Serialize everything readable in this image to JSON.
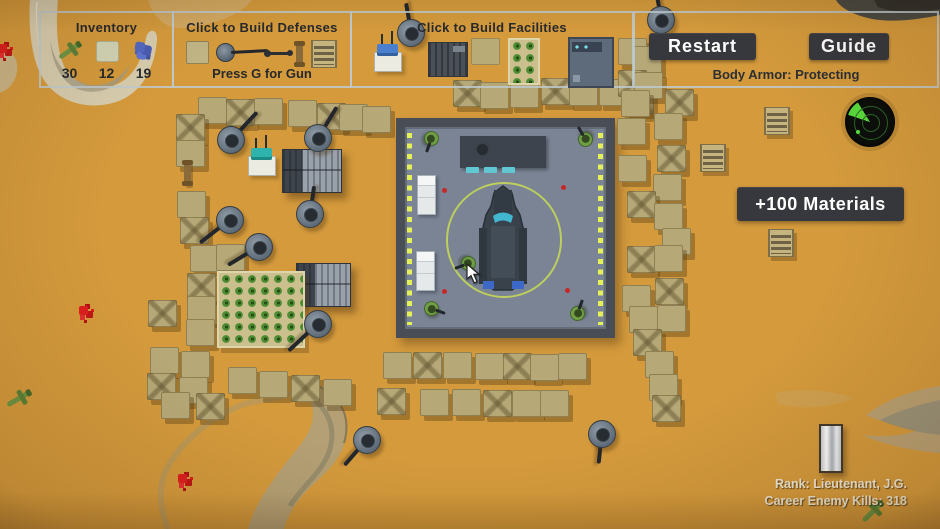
{
  "hud": {
    "inventory": {
      "title": "Inventory",
      "items": [
        {
          "name": "plane-parts",
          "count": "30"
        },
        {
          "name": "sandbags",
          "count": "12"
        },
        {
          "name": "scrap",
          "count": "19"
        }
      ]
    },
    "defenses": {
      "title": "Click to Build Defenses",
      "hint": "Press G for Gun"
    },
    "facilities": {
      "title": "Click to Build Facilities"
    },
    "restart_label": "Restart",
    "guide_label": "Guide",
    "body_armor": "Body Armor: Protecting",
    "materials_label": "+100 Materials",
    "rank_line": "Rank: Lieutenant, J.G.",
    "kills_line": "Career Enemy Kills: 318"
  },
  "colors": {
    "sand": "#d49a3c",
    "ui_border": "#becacf",
    "button_bg": "#36383d",
    "base_fill": "#7a8495",
    "base_border": "#484d56",
    "dash_yellow": "#e6f157",
    "sandbag": "#b6a877",
    "crop_green": "#4e8c33",
    "alert_red": "#c62828",
    "radar_green": "#59e23b",
    "rank_text": "#efe7d2"
  },
  "world": {
    "sandbags": [
      [
        198,
        97
      ],
      [
        226,
        99
      ],
      [
        254,
        98
      ],
      [
        288,
        100
      ],
      [
        317,
        103
      ],
      [
        339,
        104
      ],
      [
        362,
        106
      ],
      [
        176,
        114
      ],
      [
        176,
        140
      ],
      [
        177,
        191
      ],
      [
        180,
        217
      ],
      [
        190,
        245
      ],
      [
        216,
        244
      ],
      [
        187,
        273
      ],
      [
        187,
        296
      ],
      [
        186,
        319
      ],
      [
        148,
        300
      ],
      [
        150,
        347
      ],
      [
        181,
        351
      ],
      [
        147,
        373
      ],
      [
        179,
        377
      ],
      [
        161,
        392
      ],
      [
        196,
        393
      ],
      [
        228,
        367
      ],
      [
        259,
        371
      ],
      [
        291,
        375
      ],
      [
        323,
        379
      ],
      [
        383,
        352
      ],
      [
        413,
        352
      ],
      [
        443,
        352
      ],
      [
        475,
        353
      ],
      [
        503,
        353
      ],
      [
        530,
        354
      ],
      [
        558,
        353
      ],
      [
        377,
        388
      ],
      [
        420,
        389
      ],
      [
        452,
        389
      ],
      [
        483,
        390
      ],
      [
        512,
        390
      ],
      [
        540,
        390
      ],
      [
        453,
        80
      ],
      [
        480,
        82
      ],
      [
        510,
        81
      ],
      [
        541,
        78
      ],
      [
        569,
        79
      ],
      [
        599,
        79
      ],
      [
        625,
        87
      ],
      [
        618,
        38
      ],
      [
        633,
        46
      ],
      [
        618,
        70
      ],
      [
        634,
        72
      ],
      [
        621,
        90
      ],
      [
        665,
        89
      ],
      [
        654,
        113
      ],
      [
        617,
        118
      ],
      [
        657,
        145
      ],
      [
        618,
        155
      ],
      [
        653,
        174
      ],
      [
        627,
        191
      ],
      [
        654,
        203
      ],
      [
        662,
        228
      ],
      [
        627,
        246
      ],
      [
        654,
        245
      ],
      [
        622,
        285
      ],
      [
        655,
        278
      ],
      [
        629,
        306
      ],
      [
        657,
        305
      ],
      [
        633,
        329
      ],
      [
        645,
        351
      ],
      [
        649,
        374
      ],
      [
        652,
        395
      ]
    ],
    "posts": [
      [
        184,
        161
      ]
    ],
    "turrets": [
      [
        231,
        140,
        -47,
        38
      ],
      [
        318,
        138,
        -59,
        36
      ],
      [
        411,
        33,
        -100,
        30
      ],
      [
        661,
        20,
        -100,
        26
      ],
      [
        310,
        214,
        -82,
        28
      ],
      [
        230,
        220,
        142,
        38
      ],
      [
        259,
        247,
        149,
        36
      ],
      [
        318,
        324,
        137,
        40
      ],
      [
        367,
        440,
        131,
        34
      ],
      [
        602,
        434,
        96,
        30
      ]
    ],
    "soldiers": [
      [
        424,
        131,
        110
      ],
      [
        578,
        132,
        -120
      ],
      [
        461,
        256,
        160
      ],
      [
        424,
        301,
        20
      ],
      [
        570,
        306,
        -70
      ]
    ],
    "barricades": [
      [
        764,
        107
      ],
      [
        700,
        144
      ],
      [
        768,
        229
      ]
    ],
    "radios": [
      [
        248,
        143
      ]
    ],
    "buildings": [
      [
        282,
        149,
        58,
        42
      ],
      [
        296,
        263,
        53,
        42
      ]
    ],
    "crops": [
      [
        217,
        271,
        84,
        73
      ]
    ],
    "flowers": [
      [
        -2,
        44
      ],
      [
        79,
        306
      ],
      [
        178,
        474
      ]
    ],
    "wrecks": [
      [
        6,
        391,
        -30
      ],
      [
        860,
        504,
        -45
      ]
    ],
    "doors": [
      [
        819,
        424,
        20,
        45
      ]
    ]
  },
  "base": {
    "x": 396,
    "y": 118,
    "w": 219,
    "h": 220,
    "dash_cols": [
      2,
      193
    ],
    "dash_top": 6,
    "dash_h": 192,
    "desk": {
      "x": 55,
      "y": 9,
      "w": 86,
      "h": 32
    },
    "person": {
      "x": 70,
      "y": 15
    },
    "chairs": [
      [
        61,
        40
      ],
      [
        79,
        40
      ],
      [
        97,
        40
      ]
    ],
    "beds": [
      [
        12,
        48
      ],
      [
        11,
        124
      ]
    ],
    "dots": [
      [
        37,
        61
      ],
      [
        156,
        58
      ],
      [
        37,
        162
      ],
      [
        160,
        161
      ]
    ],
    "circle": {
      "cx": 97,
      "cy": 111,
      "r": 56
    },
    "vehicle": {
      "x": 71,
      "y": 57
    }
  },
  "cursor": {
    "x": 466,
    "y": 263
  },
  "terrain": [
    {
      "d": "M30,-2 L58,-2 C56,22 56,48 64,66 C74,84 94,92 112,86 C132,80 142,62 146,38 C148,28 158,28 157,40 C154,72 140,94 116,102 C88,111 58,102 44,80 C32,62 28,30 30,-2 Z",
      "fill": "#d7ccae",
      "opacity": 1
    },
    {
      "d": "M50,40 C54,62 66,78 86,84 C104,88 120,80 130,64 C124,84 104,95 84,91 C64,87 52,66 50,40 Z",
      "fill": "#a29b82",
      "opacity": 0.75
    },
    {
      "d": "M36,2 C35,28 38,54 48,72 C40,58 34,28 38,2 Z",
      "fill": "#efe9d8",
      "opacity": 0.8
    },
    {
      "d": "M148,0 L252,0 C240,16 208,27 180,28 C163,28 152,14 148,0 Z",
      "fill": "#d2c098",
      "opacity": 0.4
    },
    {
      "d": "M-4,46 C10,48 19,58 17,71 C15,85 5,93 -4,93 Z",
      "fill": "#c9b88e",
      "opacity": 0.9
    },
    {
      "d": "M316,384 C342,396 352,418 345,442 C337,469 314,480 298,501 C290,512 286,521 284,529 L248,529 C254,507 267,488 282,468 C299,446 312,434 313,415 C314,401 304,392 294,388 Z",
      "fill": "#b2a077",
      "opacity": 0.95
    },
    {
      "d": "M312,398 C330,412 336,430 329,452 C321,474 302,486 290,506",
      "stroke": "#8b8468",
      "sw": 5,
      "opacity": 0.7
    },
    {
      "d": "M318,386 C343,398 351,419 344,443",
      "stroke": "#776e53",
      "sw": 2,
      "opacity": 0.8
    },
    {
      "d": "M314,387 C290,395 268,399 252,402 C222,409 182,438 166,470 C158,487 160,510 168,529",
      "stroke": "#b5985e",
      "sw": 6,
      "opacity": 0.75
    },
    {
      "d": "M940,386 C908,391 884,401 866,415 C880,422 900,426 918,430 C900,437 880,437 862,435 C886,446 916,451 940,453 Z",
      "fill": "#b7a278",
      "opacity": 0.9
    },
    {
      "d": "M940,400 C916,405 896,412 880,420 C898,428 920,433 940,435 Z",
      "fill": "#94907b",
      "opacity": 0.8
    },
    {
      "d": "M836,0 L940,0 L940,15 C912,21 884,23 864,17 C850,13 840,7 836,0 Z",
      "fill": "#4a4a42",
      "opacity": 1
    },
    {
      "d": "M874,0 L940,0 L940,9 C916,14 892,13 878,7 Z",
      "fill": "#2f2f2a",
      "opacity": 0.9
    },
    {
      "d": "M775,393 C800,388 832,390 853,398 C832,408 800,410 778,404 Z",
      "fill": "#c7a96b",
      "opacity": 0.4
    }
  ]
}
